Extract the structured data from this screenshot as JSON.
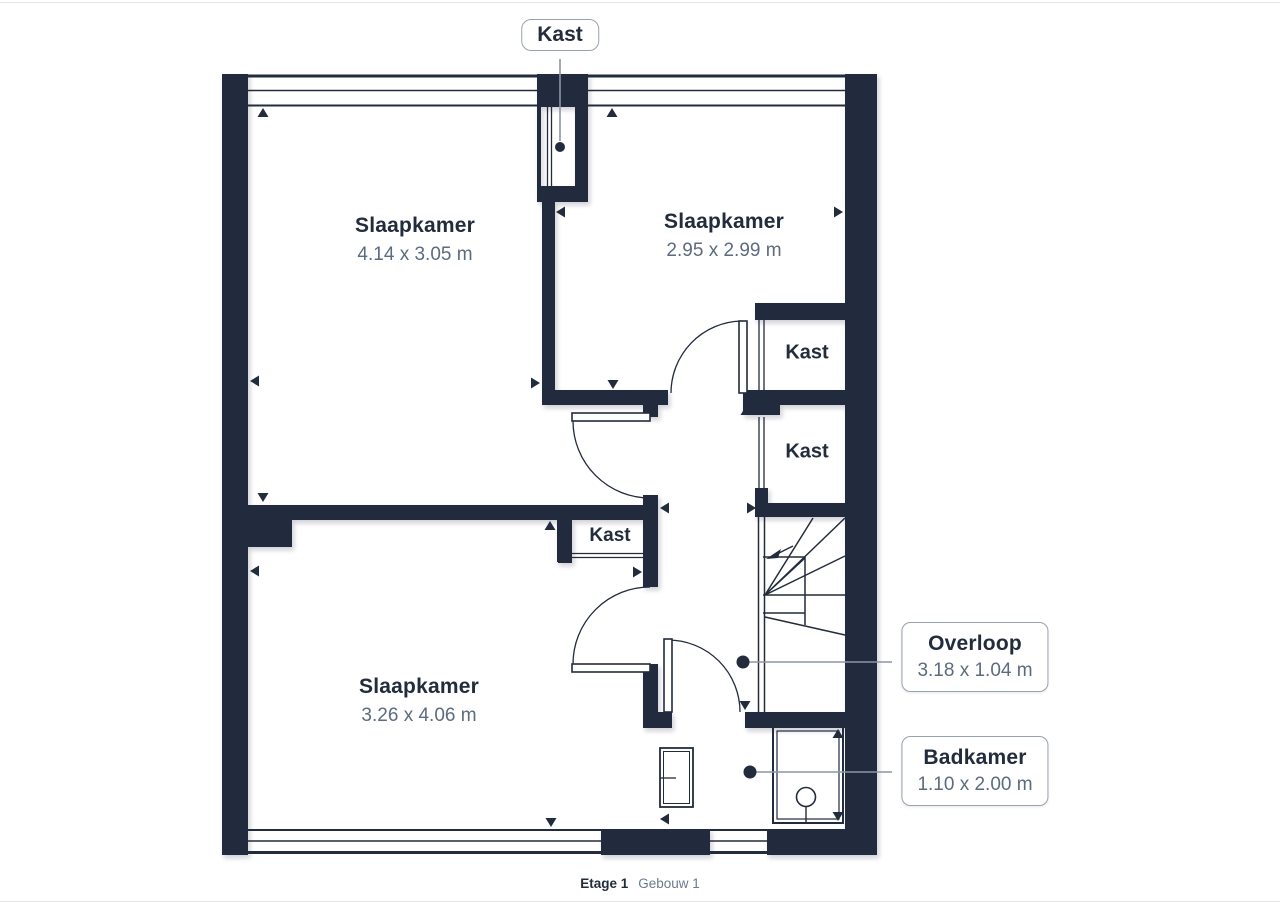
{
  "plan": {
    "rooms": [
      {
        "name": "Slaapkamer",
        "dims": "4.14 x 3.05 m"
      },
      {
        "name": "Slaapkamer",
        "dims": "2.95 x 2.99 m"
      },
      {
        "name": "Slaapkamer",
        "dims": "3.26 x 4.06 m"
      },
      {
        "name": "Overloop",
        "dims": "3.18 x 1.04 m"
      },
      {
        "name": "Badkamer",
        "dims": "1.10 x 2.00 m"
      }
    ],
    "closet_labels": [
      "Kast",
      "Kast",
      "Kast",
      "Kast"
    ],
    "caption": {
      "level": "Etage 1",
      "building": "Gebouw 1"
    },
    "colors": {
      "wall": "#222C3C",
      "room_name_text": "#222C3C",
      "dimension_text": "#5C6B7E",
      "leader_line": "#8C96A5",
      "callout_border": "#99A3B0"
    }
  }
}
